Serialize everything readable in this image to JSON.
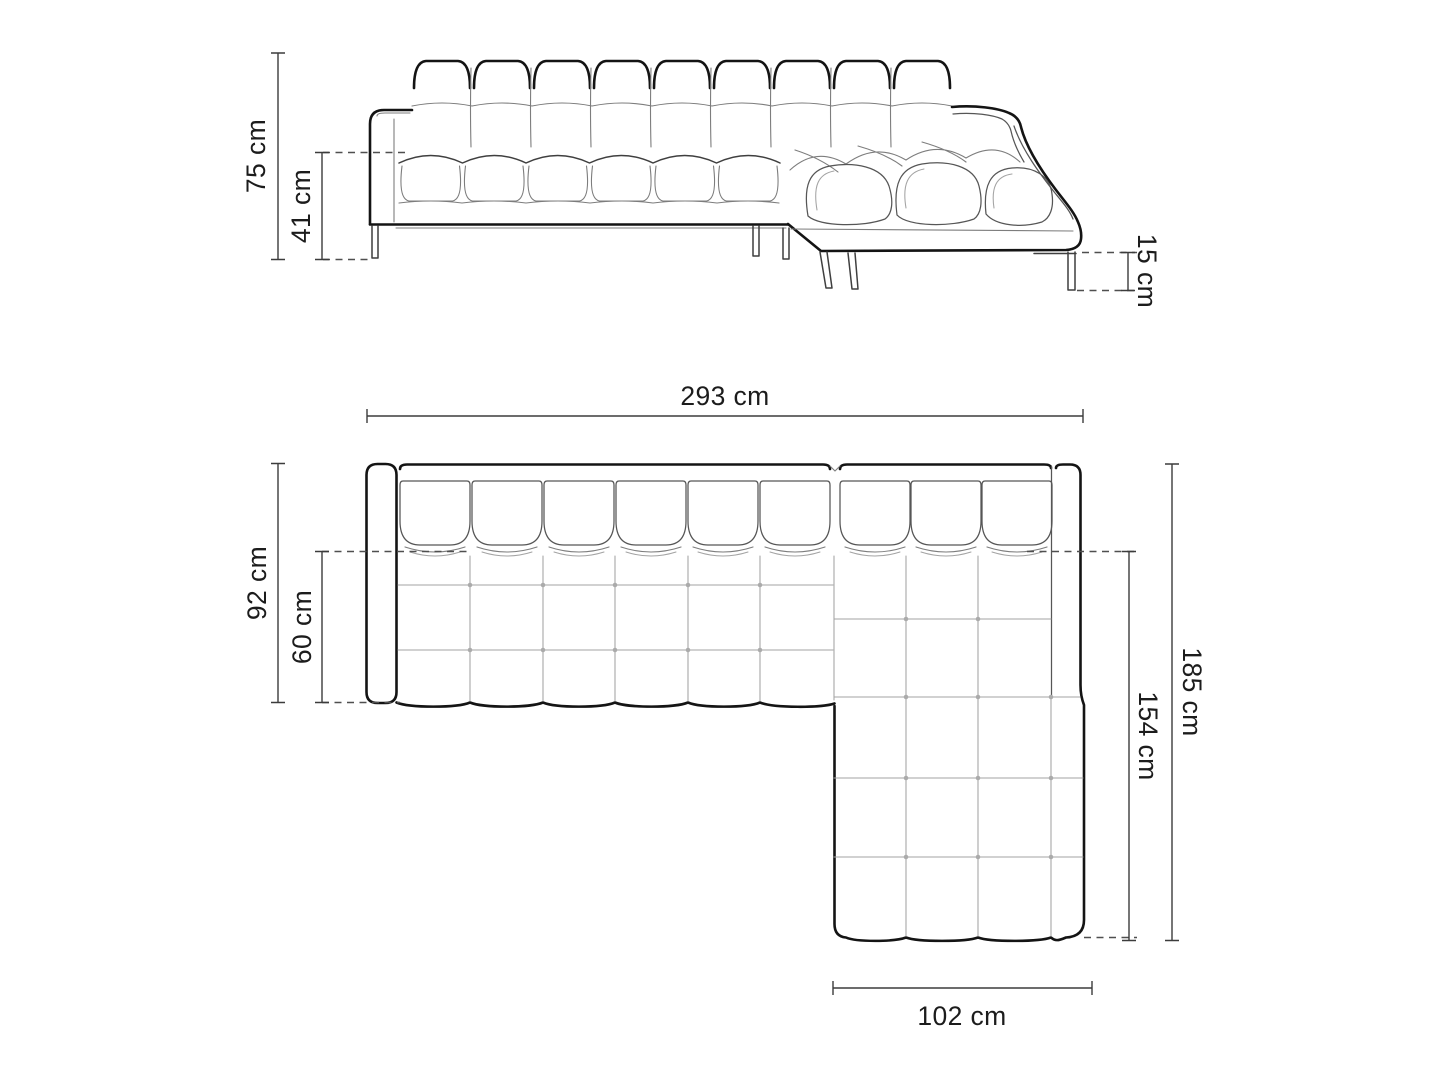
{
  "figure": {
    "kind": "sofa-dimension-diagram",
    "views": {
      "front": {
        "name": "front-elevation"
      },
      "plan": {
        "name": "top-plan"
      }
    }
  },
  "dims": {
    "height_total": {
      "label": "75 cm",
      "value_cm": 75,
      "view": "front",
      "axis": "vertical"
    },
    "height_seat": {
      "label": "41 cm",
      "value_cm": 41,
      "view": "front",
      "axis": "vertical"
    },
    "height_legs": {
      "label": "15 cm",
      "value_cm": 15,
      "view": "front",
      "axis": "vertical"
    },
    "width_total": {
      "label": "293 cm",
      "value_cm": 293,
      "view": "plan",
      "axis": "horizontal"
    },
    "depth_total": {
      "label": "92 cm",
      "value_cm": 92,
      "view": "plan",
      "axis": "vertical"
    },
    "depth_seat": {
      "label": "60 cm",
      "value_cm": 60,
      "view": "plan",
      "axis": "vertical"
    },
    "length_total": {
      "label": "185 cm",
      "value_cm": 185,
      "view": "plan",
      "axis": "vertical"
    },
    "length_chaise_seat": {
      "label": "154 cm",
      "value_cm": 154,
      "view": "plan",
      "axis": "vertical"
    },
    "width_chaise": {
      "label": "102 cm",
      "value_cm": 102,
      "view": "plan",
      "axis": "horizontal"
    }
  },
  "colors": {
    "background": "#ffffff",
    "outline": "#141414",
    "secondary_line": "#565656",
    "grid_line": "#a3a3a3",
    "dimension_line": "#3c3c3c",
    "label_text": "#1c1c1c"
  }
}
